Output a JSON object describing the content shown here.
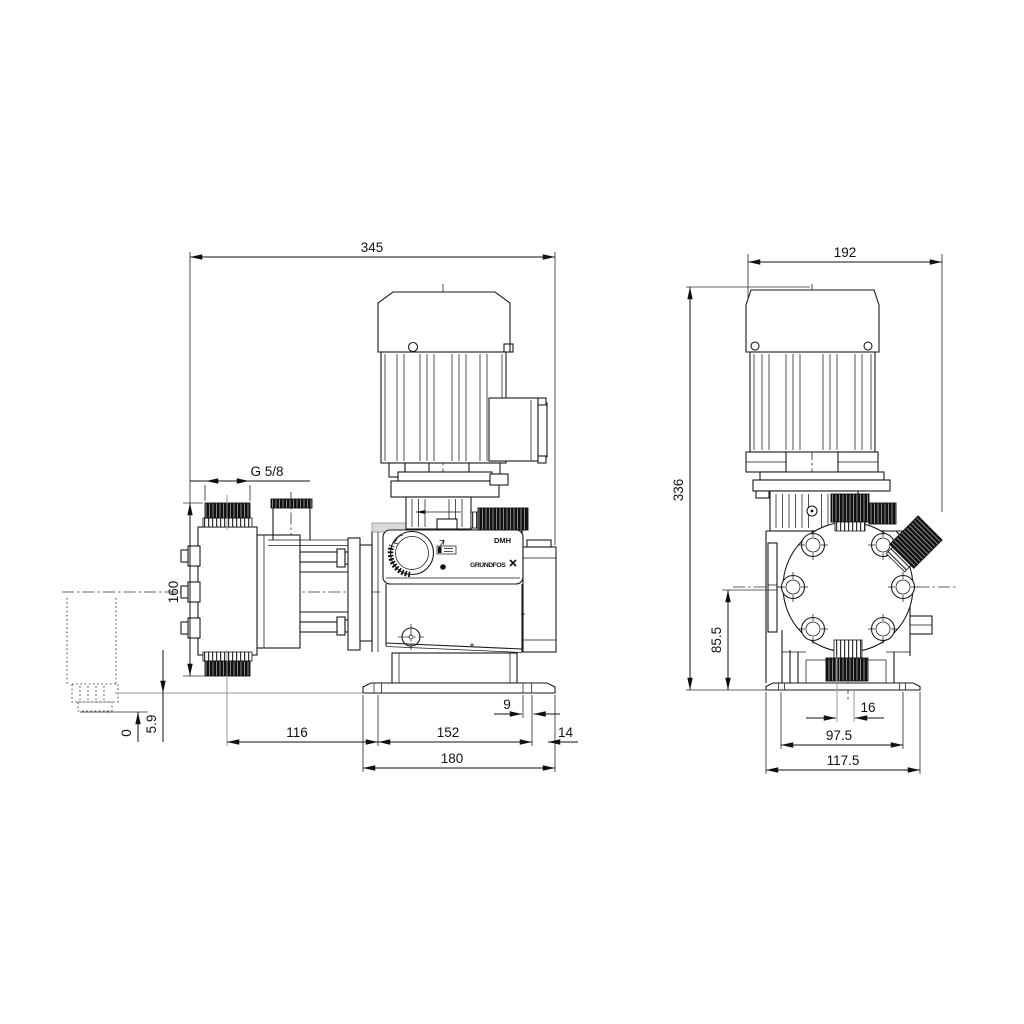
{
  "drawing": {
    "type": "technical-dimension-drawing",
    "product": "dosing pump, side and front views",
    "model_label": "DMH",
    "brand_label": "GRUNDFOS"
  },
  "side_view": {
    "dim_overall_length": "345",
    "dim_connection_thread": "G 5/8",
    "dim_head_height": "160",
    "dim_ref_zero": "0",
    "dim_foot_height": "5.9",
    "dim_head_to_base": "116",
    "dim_base_slot_span": "152",
    "dim_base_overhang": "14",
    "dim_base_length": "180",
    "dim_slot_width": "9"
  },
  "front_view": {
    "dim_overall_width": "192",
    "dim_overall_height": "336",
    "dim_center_to_base": "85.5",
    "dim_valve_offset": "16",
    "dim_slot_spacing": "97.5",
    "dim_base_width": "117.5"
  }
}
